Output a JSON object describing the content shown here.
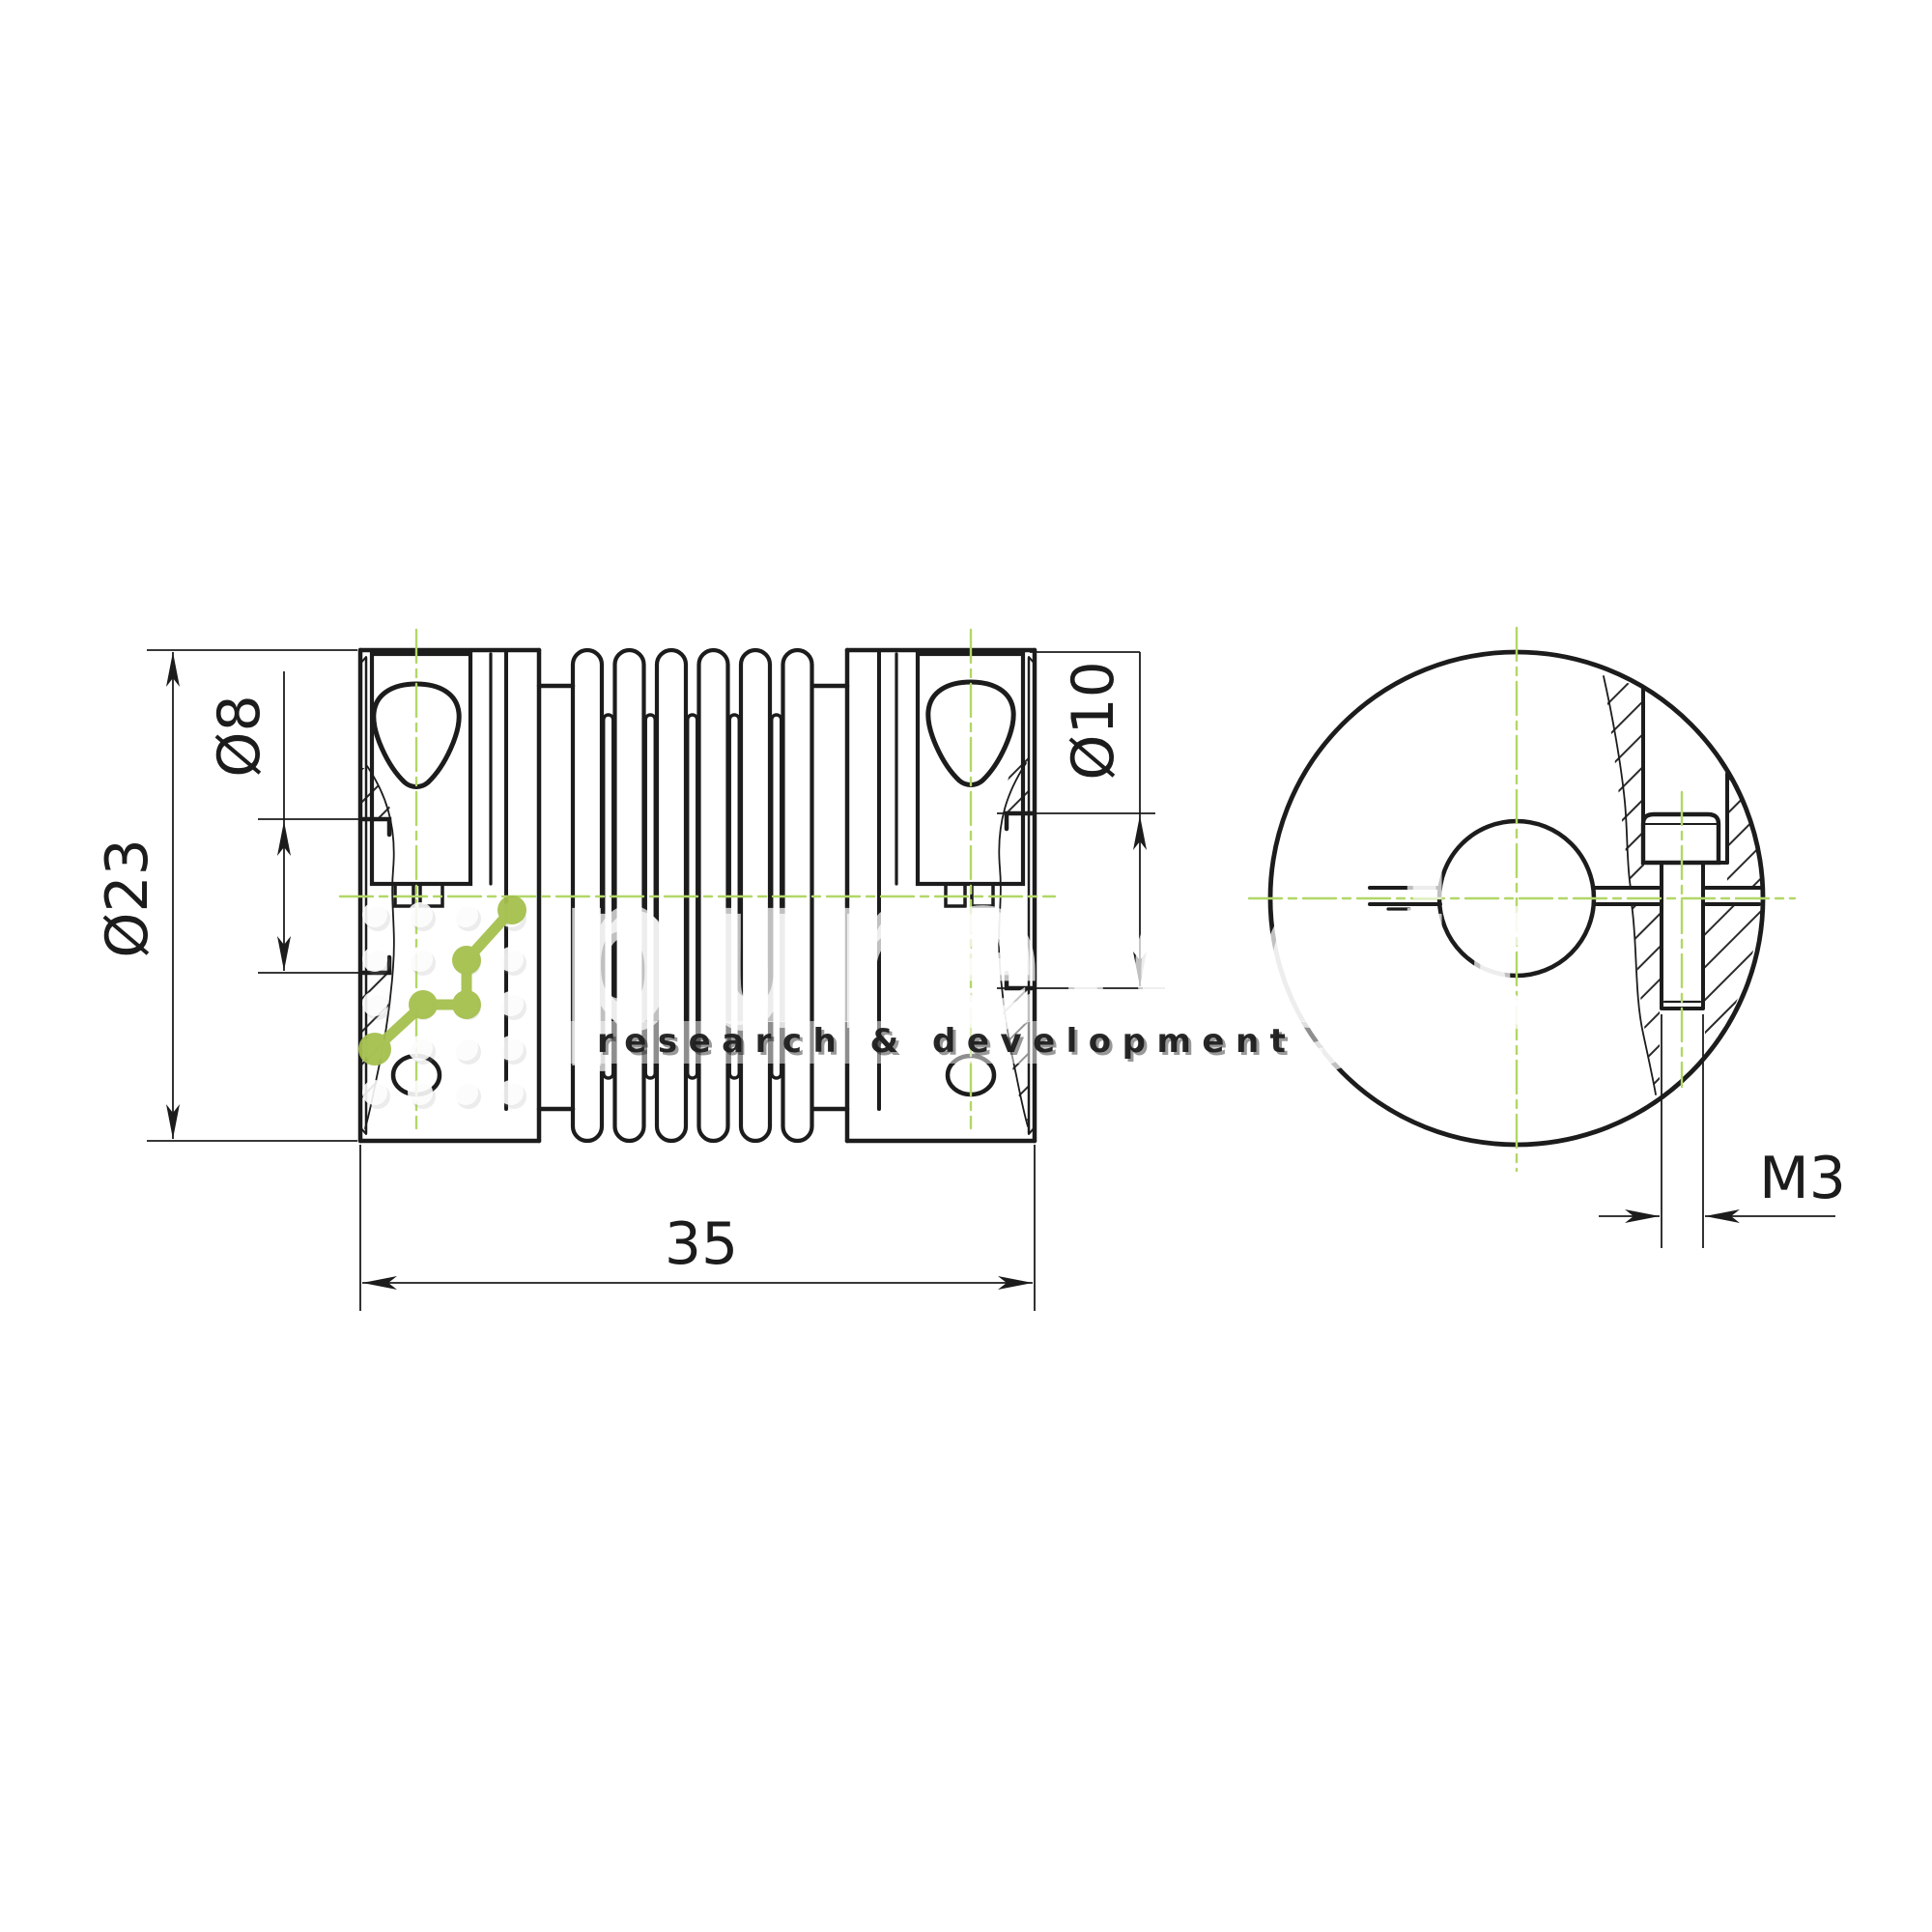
{
  "drawing": {
    "type": "technical-drawing",
    "part": "bellows coupling, two clamp hubs, side section view and end view",
    "dimensions": {
      "outer_diameter": "Ø23",
      "bore_left": "Ø8",
      "bore_right": "Ø10",
      "overall_length": "35",
      "clamp_screw_thread": "M3"
    },
    "watermark": {
      "brand": "purelogic",
      "tagline": "research & development"
    },
    "icons": {
      "logo": "pulse-node-logo",
      "grid": "dot-grid-pattern"
    },
    "colors": {
      "line": "#1c1c1c",
      "centerline_green": "#b2d768",
      "logo_green": "#a5c04d",
      "watermark_white": "#ffffff"
    }
  }
}
